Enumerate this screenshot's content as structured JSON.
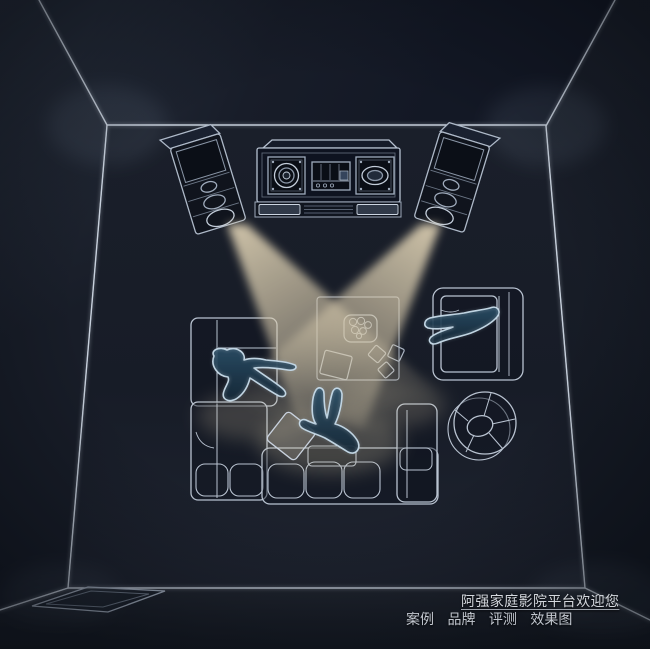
{
  "caption": {
    "welcome_text": "阿强家庭影院平台欢迎您",
    "nav_items": [
      "案例",
      "品牌",
      "评测",
      "效果图"
    ]
  },
  "colors": {
    "background": "#161b26",
    "wall_line": "#c9d2de",
    "furniture_line": "#b9c3d1",
    "equipment_line": "#c3cdda",
    "beam": "#d8caa9",
    "person_fill": "#204055",
    "person_outline": "#c8dcea",
    "caption_text": "#d4d8de",
    "nav_text": "#c3c8d0"
  },
  "scene_objects": [
    "room-wireframe",
    "left-tower-speaker",
    "right-tower-speaker",
    "media-console",
    "sound-beam-left",
    "sound-beam-right",
    "sectional-sofa-left",
    "sofa-bottom",
    "armchair-right",
    "round-chair",
    "coffee-table",
    "snack-plate",
    "floor-cushion",
    "floor-rug",
    "person-lying-on-sofa",
    "person-sitting-on-floor",
    "person-lounging-on-armchair"
  ]
}
